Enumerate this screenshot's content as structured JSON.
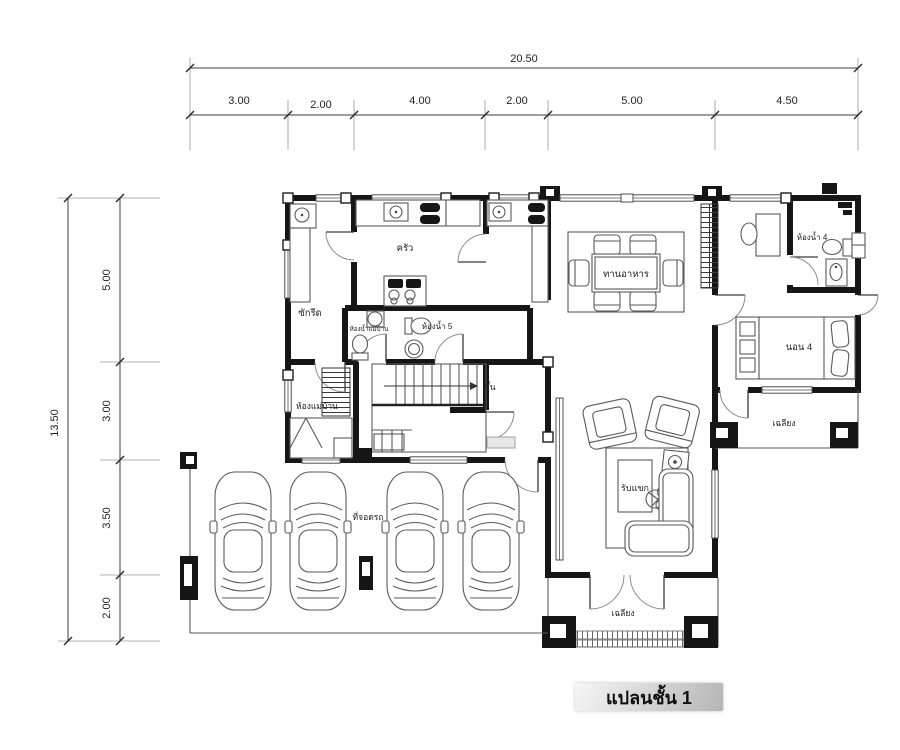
{
  "title": "แปลนชั้น 1",
  "dimensions": {
    "top": {
      "total": "20.50",
      "segments": [
        "3.00",
        "2.00",
        "4.00",
        "2.00",
        "5.00",
        "4.50"
      ]
    },
    "left": {
      "total": "13.50",
      "segments": [
        "5.00",
        "3.00",
        "3.50",
        "2.00"
      ]
    }
  },
  "rooms": {
    "kitchen": {
      "label": "ครัว"
    },
    "laundry": {
      "label": "ซักรีด"
    },
    "maid_bath": {
      "label": "ห้องน้ำแม่บ้าน"
    },
    "bath5": {
      "label": "ห้องน้ำ 5"
    },
    "dining": {
      "label": "ทานอาหาร"
    },
    "bath4": {
      "label": "ห้องน้ำ 4"
    },
    "bed4": {
      "label": "นอน 4"
    },
    "maid_room": {
      "label": "ห้องแม่บ้าน"
    },
    "stairs": {
      "label": "ขึ้น"
    },
    "living": {
      "label": "รับแขก"
    },
    "porch_right": {
      "label": "เฉลียง"
    },
    "porch_front": {
      "label": "เฉลียง"
    },
    "carport": {
      "label": "ที่จอดรถ"
    }
  },
  "colors": {
    "wall_color": "#161616",
    "line_color": "#5a5a5a",
    "light_line": "#9a9a9a",
    "label_color": "#222222",
    "title_text": "#101010",
    "title_band_light": "#f6f6f6",
    "title_band_dark": "#b5b5b5"
  }
}
